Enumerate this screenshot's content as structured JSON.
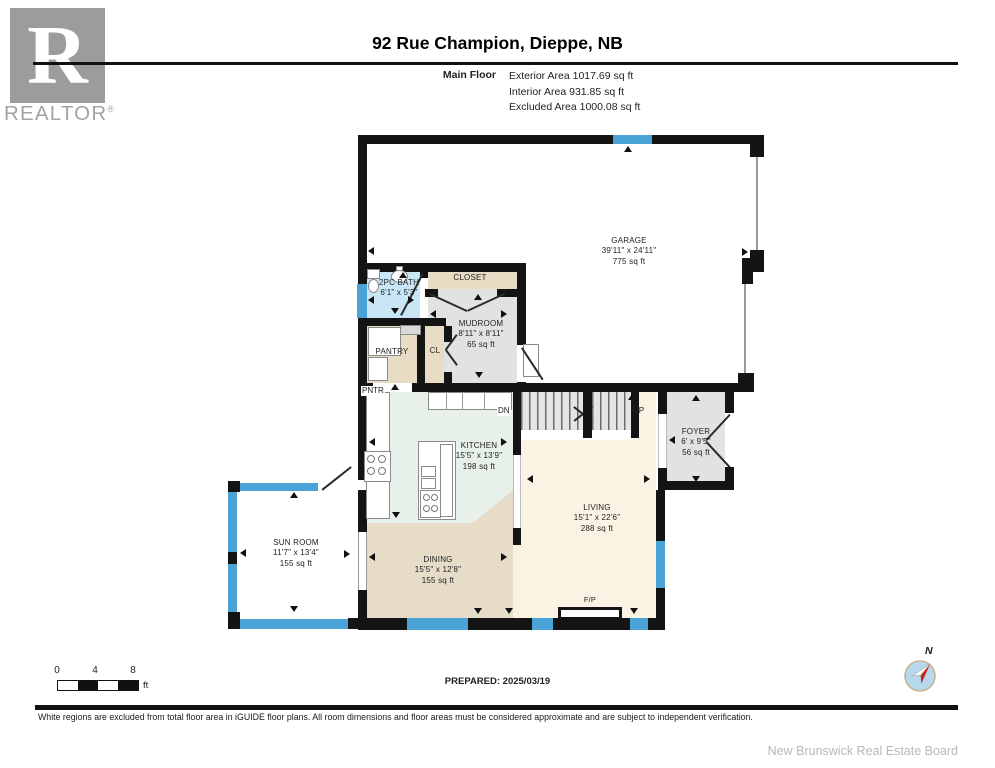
{
  "header": {
    "brand": {
      "letter": "R",
      "name": "REALTOR",
      "registered": "®"
    },
    "title": "92 Rue Champion, Dieppe, NB",
    "floor": "Main Floor",
    "area_lines": [
      "Exterior Area 1017.69 sq ft",
      "Interior Area 931.85 sq ft",
      "Excluded Area 1000.08 sq ft"
    ]
  },
  "rooms": {
    "garage": {
      "name": "GARAGE",
      "dims": "39'11\" x 24'11\"",
      "area": "775 sq ft"
    },
    "bath": {
      "name": "2PC BATH",
      "dims": "6'1\" x 5'3\""
    },
    "closet": {
      "name": "CLOSET"
    },
    "mudroom": {
      "name": "MUDROOM",
      "dims": "8'11\" x 8'11\"",
      "area": "65 sq ft"
    },
    "pantry": {
      "name": "PANTRY"
    },
    "pantry_cab": {
      "name": "PNTR"
    },
    "cl": {
      "name": "CL"
    },
    "kitchen": {
      "name": "KITCHEN",
      "dims": "15'5\" x 13'9\"",
      "area": "198 sq ft"
    },
    "foyer": {
      "name": "FOYER",
      "dims": "6' x 9'5\"",
      "area": "56 sq ft"
    },
    "living": {
      "name": "LIVING",
      "dims": "15'1\" x 22'6\"",
      "area": "288 sq ft"
    },
    "dining": {
      "name": "DINING",
      "dims": "15'5\" x 12'8\"",
      "area": "155 sq ft"
    },
    "sunroom": {
      "name": "SUN ROOM",
      "dims": "11'7\" x 13'4\"",
      "area": "155 sq ft"
    },
    "stairs_down": "DN",
    "stairs_up": "UP",
    "fireplace": "F/P"
  },
  "scale_bar": {
    "ticks": [
      "0",
      "4",
      "8"
    ],
    "unit": "ft"
  },
  "compass": {
    "label": "N"
  },
  "prepared": "PREPARED: 2025/03/19",
  "footer": {
    "disclaimer": "White regions are excluded from total floor area in iGUIDE floor plans. All room dimensions and floor areas must be considered approximate and are subject to independent verification.",
    "board": "New Brunswick Real Estate Board"
  },
  "colors": {
    "wall": "#141414",
    "window_blue": "#4aa3d6",
    "bath_blue": "#c9e6f6",
    "tan": "#e8dcc4",
    "room_gray": "#e2e2e2",
    "kitchen_mint": "#e7f1ea",
    "living_cream": "#faf3e3",
    "dining_tan": "#e6dcc7",
    "logo_gray": "#9c9c9c"
  }
}
